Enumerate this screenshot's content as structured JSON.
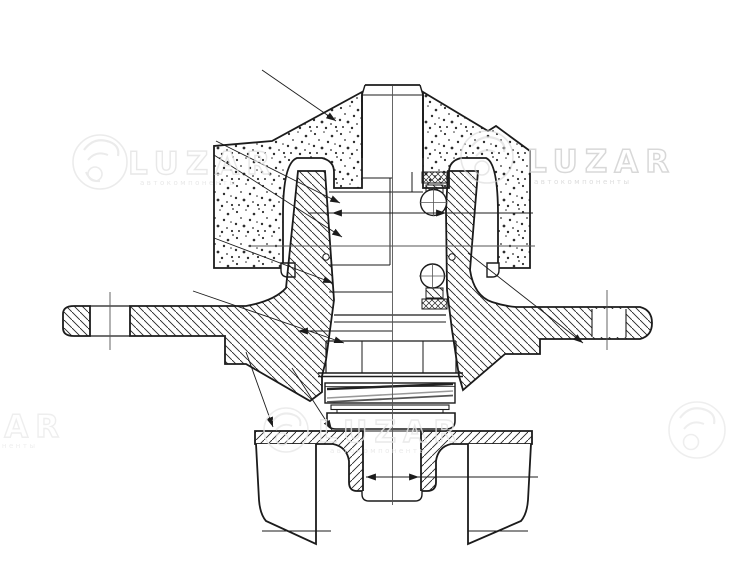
{
  "canvas": {
    "background": "#ffffff",
    "line_color": "#1b1b1b",
    "thin_line_color": "#444444"
  },
  "watermark": {
    "brand": "LUZAR",
    "tagline": "автокомпоненты",
    "color_light": "#e8e8e8",
    "color_mid": "#d2d2d2"
  }
}
